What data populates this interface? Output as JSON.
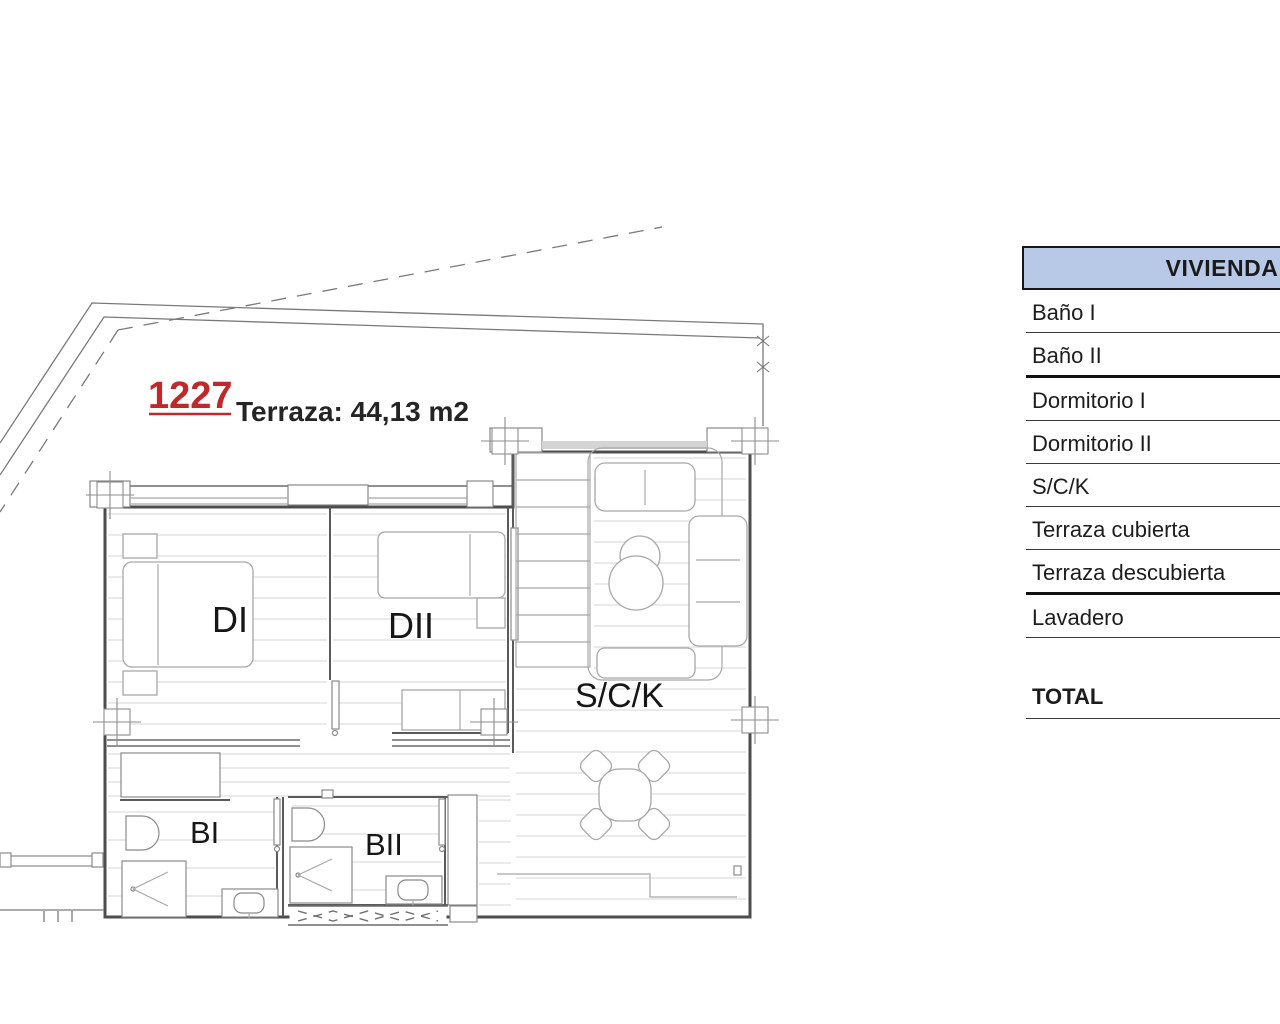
{
  "plan": {
    "unit_number": "1227",
    "terrace_label": "Terraza: 44,13 m2",
    "accent_color": "#c02929",
    "rooms": {
      "dormitorio1": "DI",
      "dormitorio2": "DII",
      "salon": "S/C/K",
      "bano1": "BI",
      "bano2": "BII"
    }
  },
  "table": {
    "header": "VIVIENDA",
    "header_fill": "#b8c9e8",
    "rows": [
      {
        "label": "Baño I"
      },
      {
        "label": "Baño II"
      },
      {
        "label": "Dormitorio I"
      },
      {
        "label": "Dormitorio II"
      },
      {
        "label": "S/C/K"
      },
      {
        "label": "Terraza cubierta"
      },
      {
        "label": "Terraza descubierta"
      },
      {
        "label": "Lavadero"
      }
    ],
    "total_label": "TOTAL"
  }
}
